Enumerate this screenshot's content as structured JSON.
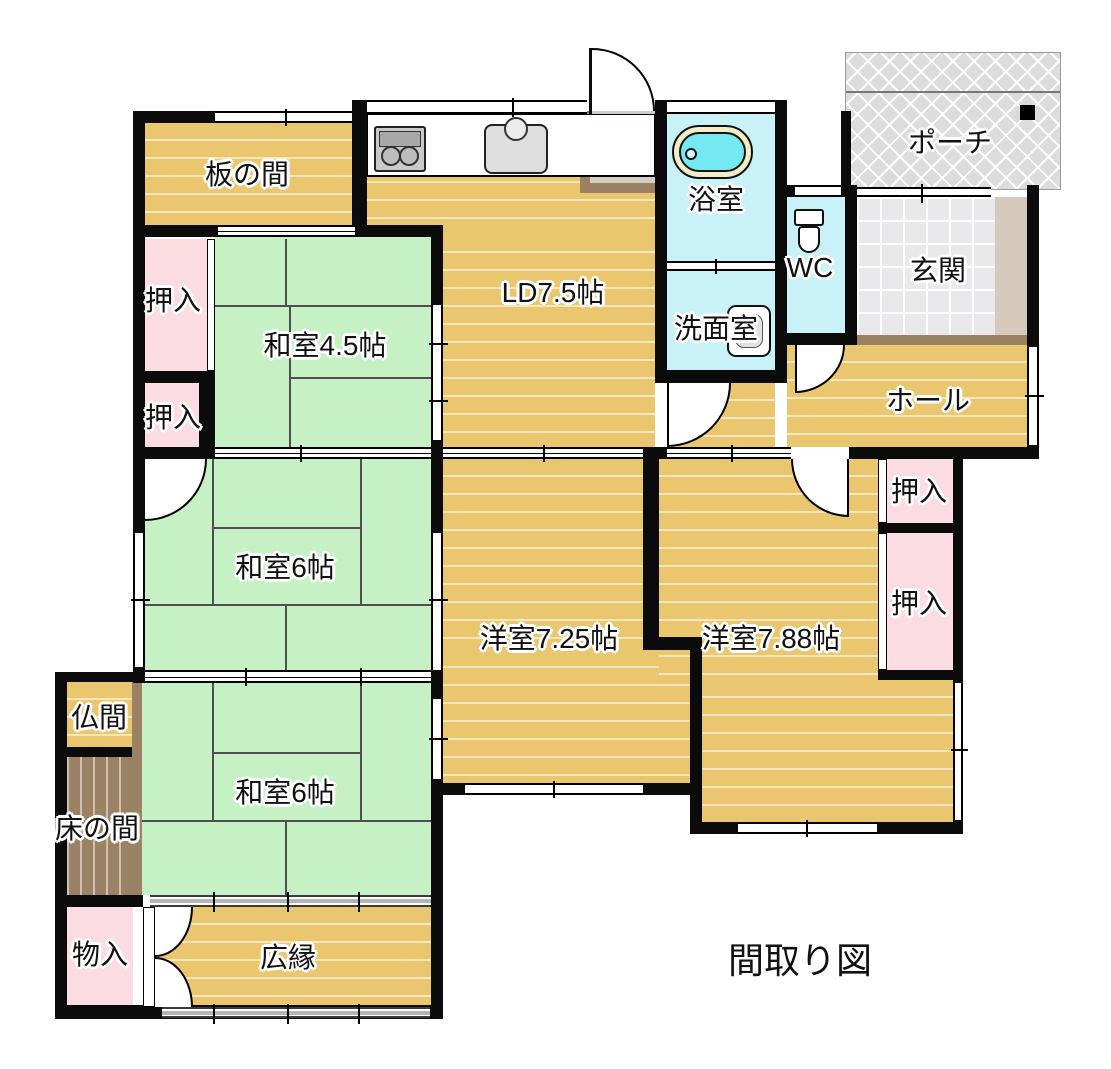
{
  "title": "間取り図",
  "rooms": {
    "itanoma": "板の間",
    "ld": "LD7.5帖",
    "washitsu45": "和室4.5帖",
    "washitsu6_upper": "和室6帖",
    "washitsu6_lower": "和室6帖",
    "yoshitsu725": "洋室7.25帖",
    "yoshitsu788": "洋室7.88帖",
    "yokushitsu": "浴室",
    "senmenshitsu": "洗面室",
    "wc": "WC",
    "genkan": "玄関",
    "porch": "ポーチ",
    "hall": "ホール",
    "butsuma": "仏間",
    "tokonoma": "床の間",
    "mononyu": "物入",
    "hiroen": "広縁",
    "oshiire_nw_upper": "押入",
    "oshiire_nw_lower": "押入",
    "oshiire_e_upper": "押入",
    "oshiire_e_lower": "押入"
  },
  "colors": {
    "wood_floor": "#eac76f",
    "tatami_green": "#c5f1c5",
    "closet_pink": "#fbdce0",
    "wet_area_cyan": "#c9f2f8",
    "bathtub_cyan": "#74e9f1",
    "entrance_tile": "#e9e9eb",
    "porch_gray": "#dcdcdc",
    "tokonoma_brown": "#9c8265",
    "step_beige": "#d4cdc3",
    "wall_black": "#0b0b0b"
  },
  "icons": {
    "stove": "stove-icon",
    "sink": "sink-icon",
    "bathtub": "bathtub-icon",
    "washbasin": "washbasin-icon",
    "toilet": "toilet-icon",
    "pillar": "pillar-icon"
  }
}
